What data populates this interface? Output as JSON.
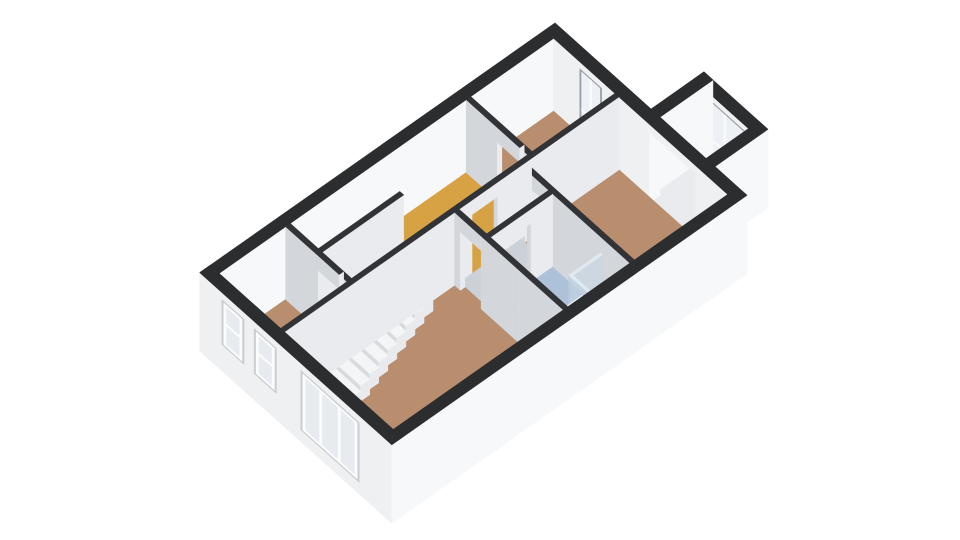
{
  "meta": {
    "view_label": "3D dollhouse floor plan view",
    "background": "#ffffff"
  },
  "floorplan": {
    "projection": {
      "ox": 555,
      "oy": 23,
      "eu": [
        32,
        28.7
      ],
      "ev": [
        -37,
        26
      ],
      "hz": 28,
      "wallH": 2.6
    },
    "palette": {
      "ext": {
        "top": "#2c2d2f",
        "pu": "#f7f8f9",
        "pv": "#eef0f2"
      },
      "int": {
        "top": "#323336",
        "pu": "#e9ebee",
        "pv": "#d3d6da"
      },
      "fix": {
        "top": "#f7f8fa",
        "pu": "#e7eaec",
        "pv": "#d9dce0"
      },
      "fixlight": {
        "top": "#eef0f2",
        "pu": "#e2e5e8",
        "pv": "#d6dade"
      },
      "rail": {
        "top": "#fbfcfd",
        "pu": "#f1f2f4",
        "pv": "#e4e6e9"
      },
      "door": {
        "top": "#f4f5f7",
        "pu": "#eceef0",
        "pv": "#e0e2e5"
      },
      "step": {
        "top": "#f4f5f7",
        "pu": "#e8eaed",
        "pv": "#d8dbde"
      },
      "glass": {
        "top": "rgba(226,236,243,0.85)",
        "pu": "rgba(198,215,229,0.5)",
        "pv": "rgba(188,207,223,0.55)"
      },
      "floors": {
        "brown": "#b98e6f",
        "yellow": "#d7a243",
        "bath": "#adc2d8",
        "gray": "#ccd1d7",
        "bay": "#e9ebee",
        "hole": "#83878c"
      },
      "window": {
        "frame": "#9aa0a6",
        "glass": "#edf1f5",
        "mullion": "#f8fafb"
      },
      "outwin": {
        "recess": "#c9ccd0",
        "frame": "#fbfcfd",
        "glass": "#e7ebef"
      }
    },
    "items": [
      {
        "t": "box",
        "id": "bay-front-wall",
        "rect": [
          3.0,
          -1.43,
          5.0,
          -1.15
        ],
        "z": [
          -0.2,
          2.6
        ],
        "c": "ext"
      },
      {
        "t": "window",
        "id": "bay-window",
        "vc": -1.15,
        "u": [
          3.18,
          4.82
        ],
        "z": [
          0.18,
          2.38
        ],
        "mv": [
          3.98
        ],
        "mh": [
          [
            1.02,
            3.18,
            3.98
          ],
          [
            1.3,
            3.98,
            4.82
          ]
        ]
      },
      {
        "t": "box",
        "id": "bay-left-wall",
        "rect": [
          3.0,
          -1.43,
          3.28,
          0.0
        ],
        "z": [
          -0.2,
          2.6
        ],
        "c": "ext"
      },
      {
        "t": "floor",
        "id": "bay-floor",
        "rect": [
          3.28,
          -1.15,
          4.72,
          0.28
        ],
        "c": "bay"
      },
      {
        "t": "box",
        "id": "bay-window-sill",
        "rect": [
          3.28,
          -1.15,
          4.72,
          -1.03
        ],
        "z": [
          0,
          0.15
        ],
        "c": "rail"
      },
      {
        "t": "box",
        "id": "bay-right-wall",
        "rect": [
          4.72,
          -1.43,
          5.0,
          0.0
        ],
        "z": [
          -0.2,
          2.6
        ],
        "c": "ext"
      },
      {
        "t": "box",
        "id": "facade-nw",
        "rect": [
          0,
          0,
          0.28,
          9.6
        ],
        "z": [
          -0.2,
          2.6
        ],
        "c": "ext"
      },
      {
        "t": "box",
        "id": "wall-ne-west",
        "rect": [
          0.28,
          0,
          3.28,
          0.28
        ],
        "z": [
          -0.2,
          2.6
        ],
        "c": "ext"
      },
      {
        "t": "window",
        "id": "bedroom-2-window",
        "vc": 0.28,
        "u": [
          1.1,
          1.78
        ],
        "z": [
          0.15,
          2.35
        ],
        "mv": [
          1.44
        ],
        "mh": [
          [
            0.95,
            1.1,
            1.78
          ]
        ]
      },
      {
        "t": "box",
        "id": "bay-opening-lintel",
        "rect": [
          3.28,
          0,
          4.72,
          0.28
        ],
        "z": [
          2.32,
          2.6
        ],
        "c": "ext"
      },
      {
        "t": "box",
        "id": "wall-ne-east",
        "rect": [
          4.72,
          0,
          5.72,
          0.28
        ],
        "z": [
          -0.2,
          2.6
        ],
        "c": "ext"
      },
      {
        "t": "floor",
        "id": "bedroom-2-floor",
        "rect": [
          0.28,
          0.28,
          2.2,
          2.52
        ],
        "c": "brown"
      },
      {
        "t": "floor",
        "id": "bedroom-1-floor",
        "rect": [
          2.32,
          0.28,
          5.72,
          2.8
        ],
        "c": "brown"
      },
      {
        "t": "floor",
        "id": "hall-floor",
        "rect": [
          0.28,
          2.64,
          2.2,
          5.2
        ],
        "c": "yellow"
      },
      {
        "t": "floor",
        "id": "bedroom-2-door-threshold",
        "rect": [
          1.25,
          2.52,
          1.95,
          2.64
        ],
        "c": "brown"
      },
      {
        "t": "floor",
        "id": "chamber-floor",
        "rect": [
          2.32,
          2.92,
          3.18,
          4.6
        ],
        "c": "gray"
      },
      {
        "t": "floor",
        "id": "chamber-door-threshold",
        "rect": [
          2.2,
          3.55,
          2.32,
          4.25
        ],
        "c": "yellow"
      },
      {
        "t": "floor",
        "id": "bedroom-1-door-threshold",
        "rect": [
          2.45,
          2.8,
          3.1,
          2.92
        ],
        "c": "brown"
      },
      {
        "t": "floor",
        "id": "bathroom-floor",
        "rect": [
          3.3,
          2.92,
          5.72,
          4.6
        ],
        "c": "bath"
      },
      {
        "t": "floor",
        "id": "bathroom-door-threshold",
        "rect": [
          3.18,
          3.5,
          3.3,
          4.2
        ],
        "c": "bath"
      },
      {
        "t": "floor",
        "id": "closet-floor",
        "rect": [
          0.28,
          5.2,
          1.16,
          7.4
        ],
        "c": "gray"
      },
      {
        "t": "floor",
        "id": "bedroom-3-floor",
        "rect": [
          0.28,
          7.52,
          2.2,
          9.32
        ],
        "c": "brown"
      },
      {
        "t": "floor",
        "id": "bedroom-3-door-threshold",
        "rect": [
          1.3,
          7.4,
          1.95,
          7.52
        ],
        "c": "brown"
      },
      {
        "t": "floor",
        "id": "living-room-floor",
        "rect": [
          2.32,
          4.72,
          5.72,
          9.32
        ],
        "c": "brown"
      },
      {
        "t": "floor",
        "id": "living-room-door-threshold",
        "rect": [
          2.5,
          4.6,
          3.15,
          4.72
        ],
        "c": "brown"
      },
      {
        "t": "box",
        "id": "wall-bedrooms-divider",
        "rect": [
          2.2,
          0.28,
          2.32,
          2.64
        ],
        "z": [
          0,
          2.6
        ],
        "c": "int"
      },
      {
        "t": "box",
        "id": "wall-bedroom-2-south-a",
        "rect": [
          0.28,
          2.52,
          1.25,
          2.64
        ],
        "z": [
          0,
          2.6
        ],
        "c": "int"
      },
      {
        "t": "box",
        "id": "wall-bedroom-2-south-b",
        "rect": [
          1.95,
          2.52,
          2.32,
          2.64
        ],
        "z": [
          0,
          2.6
        ],
        "c": "int"
      },
      {
        "t": "box",
        "id": "bedroom-2-door-lintel",
        "rect": [
          1.25,
          2.52,
          1.95,
          2.64
        ],
        "z": [
          2.08,
          2.6
        ],
        "c": "int"
      },
      {
        "t": "box",
        "id": "wall-bedroom-1-south-a",
        "rect": [
          2.32,
          2.8,
          2.45,
          2.92
        ],
        "z": [
          0,
          2.6
        ],
        "c": "int"
      },
      {
        "t": "box",
        "id": "bedroom-1-door-lintel",
        "rect": [
          2.45,
          2.8,
          3.1,
          2.92
        ],
        "z": [
          2.08,
          2.6
        ],
        "c": "int"
      },
      {
        "t": "box",
        "id": "wall-bedroom-1-south-b",
        "rect": [
          3.1,
          2.8,
          5.72,
          2.92
        ],
        "z": [
          0,
          2.6
        ],
        "c": "int"
      },
      {
        "t": "box",
        "id": "wall-hall-east-a",
        "rect": [
          2.2,
          2.64,
          2.32,
          3.55
        ],
        "z": [
          0,
          2.6
        ],
        "c": "int"
      },
      {
        "t": "box",
        "id": "chamber-door-lintel",
        "rect": [
          2.2,
          3.55,
          2.32,
          4.25
        ],
        "z": [
          2.08,
          2.6
        ],
        "c": "int"
      },
      {
        "t": "box",
        "id": "wall-hall-east-b",
        "rect": [
          2.2,
          4.25,
          2.32,
          5.2
        ],
        "z": [
          0,
          2.6
        ],
        "c": "int"
      },
      {
        "t": "box",
        "id": "wall-chamber-east-a",
        "rect": [
          3.18,
          2.92,
          3.3,
          3.5
        ],
        "z": [
          0,
          2.6
        ],
        "c": "int"
      },
      {
        "t": "box",
        "id": "bathroom-door-lintel",
        "rect": [
          3.18,
          3.5,
          3.3,
          4.2
        ],
        "z": [
          2.08,
          2.6
        ],
        "c": "int"
      },
      {
        "t": "box",
        "id": "wall-chamber-east-b",
        "rect": [
          3.18,
          4.2,
          3.3,
          4.6
        ],
        "z": [
          0,
          2.6
        ],
        "c": "int"
      },
      {
        "t": "box",
        "id": "wall-stairwell-west",
        "rect": [
          1.16,
          5.2,
          1.28,
          7.4
        ],
        "z": [
          0,
          2.6
        ],
        "c": "int"
      },
      {
        "t": "floor",
        "id": "stairwell-hole",
        "rect": [
          1.28,
          5.2,
          2.2,
          7.4
        ],
        "c": "hole"
      },
      {
        "t": "stairs",
        "id": "staircase",
        "rect": [
          1.28,
          5.2,
          2.2,
          7.4
        ],
        "count": 9,
        "first": -0.05,
        "drop": 0.2
      },
      {
        "t": "box",
        "id": "stair-railing",
        "rect": [
          2.08,
          5.2,
          2.2,
          6.95
        ],
        "z": [
          0,
          0.95
        ],
        "c": "rail"
      },
      {
        "t": "box",
        "id": "wall-bedroom-3-north-a",
        "rect": [
          0.28,
          7.4,
          1.3,
          7.52
        ],
        "z": [
          0,
          2.6
        ],
        "c": "int"
      },
      {
        "t": "box",
        "id": "wall-bedroom-3-north-b",
        "rect": [
          1.95,
          7.4,
          2.32,
          7.52
        ],
        "z": [
          0,
          2.6
        ],
        "c": "int"
      },
      {
        "t": "box",
        "id": "bedroom-3-door-lintel",
        "rect": [
          1.3,
          7.4,
          1.95,
          7.52
        ],
        "z": [
          2.08,
          2.6
        ],
        "c": "int"
      },
      {
        "t": "box",
        "id": "bedroom-3-door-panel",
        "rect": [
          2.0,
          6.75,
          2.07,
          7.4
        ],
        "z": [
          0,
          2.04
        ],
        "c": "door"
      },
      {
        "t": "box",
        "id": "wall-living-west",
        "rect": [
          2.2,
          5.2,
          2.32,
          9.32
        ],
        "z": [
          0,
          2.6
        ],
        "c": "int"
      },
      {
        "t": "box",
        "id": "shower-glass-side",
        "rect": [
          4.8,
          2.92,
          4.86,
          3.78
        ],
        "z": [
          0,
          2.02
        ],
        "c": "glass"
      },
      {
        "t": "box",
        "id": "shower-tray",
        "rect": [
          4.86,
          2.92,
          5.72,
          3.72
        ],
        "z": [
          0,
          0.07
        ],
        "c": "fixlight"
      },
      {
        "t": "box",
        "id": "shower-head",
        "rect": [
          5.6,
          2.98,
          5.68,
          3.06
        ],
        "z": [
          1.1,
          2.15
        ],
        "c": "fix"
      },
      {
        "t": "box",
        "id": "toilet-bowl",
        "rect": [
          3.55,
          4.16,
          3.91,
          4.47
        ],
        "z": [
          0,
          0.43
        ],
        "c": "fix"
      },
      {
        "t": "box",
        "id": "toilet-tank",
        "rect": [
          3.59,
          4.47,
          3.87,
          4.6
        ],
        "z": [
          0,
          0.78
        ],
        "c": "fix"
      },
      {
        "t": "box",
        "id": "shower-glass-front",
        "rect": [
          4.86,
          3.72,
          5.72,
          3.78
        ],
        "z": [
          0,
          2.02
        ],
        "c": "glass"
      },
      {
        "t": "box",
        "id": "bathroom-cabinet",
        "rect": [
          5.42,
          3.95,
          5.72,
          4.6
        ],
        "z": [
          0,
          2.1
        ],
        "c": "fix"
      },
      {
        "t": "box",
        "id": "vanity-unit",
        "rect": [
          4.42,
          4.15,
          5.38,
          4.6
        ],
        "z": [
          0,
          0.84
        ],
        "c": "fix"
      },
      {
        "t": "box",
        "id": "vanity-sink",
        "rect": [
          4.55,
          4.22,
          5.05,
          4.52
        ],
        "z": [
          0.84,
          0.9
        ],
        "c": "rail"
      },
      {
        "t": "box",
        "id": "vanity-faucet",
        "rect": [
          4.77,
          4.5,
          4.83,
          4.56
        ],
        "z": [
          0.9,
          1.1
        ],
        "c": "fixlight"
      },
      {
        "t": "box",
        "id": "wall-bathroom-south-a",
        "rect": [
          2.32,
          4.6,
          2.5,
          4.72
        ],
        "z": [
          0,
          2.6
        ],
        "c": "int"
      },
      {
        "t": "box",
        "id": "living-room-door-lintel",
        "rect": [
          2.5,
          4.6,
          3.15,
          4.72
        ],
        "z": [
          2.08,
          2.6
        ],
        "c": "int"
      },
      {
        "t": "box",
        "id": "wall-bathroom-south-b",
        "rect": [
          3.15,
          4.6,
          4.35,
          4.72
        ],
        "z": [
          0,
          2.6
        ],
        "c": "int"
      },
      {
        "t": "box",
        "id": "wall-bathroom-south-c",
        "rect": [
          4.35,
          4.6,
          5.72,
          4.72
        ],
        "z": [
          0,
          2.6
        ],
        "c": "int"
      },
      {
        "t": "box",
        "id": "facade-se",
        "rect": [
          5.72,
          0,
          6.0,
          9.6
        ],
        "z": [
          -0.2,
          2.6
        ],
        "c": "ext"
      },
      {
        "t": "box",
        "id": "facade-sw",
        "rect": [
          0,
          9.32,
          6.0,
          9.6
        ],
        "z": [
          -0.2,
          2.6
        ],
        "c": "ext"
      },
      {
        "t": "outwin",
        "id": "bedroom-3-window-1",
        "vc": 9.6,
        "u": [
          0.75,
          1.32
        ],
        "z": [
          0.8,
          2.28
        ],
        "mh": [
          1.58
        ]
      },
      {
        "t": "outwin",
        "id": "bedroom-3-window-2",
        "vc": 9.6,
        "u": [
          1.76,
          2.33
        ],
        "z": [
          0.8,
          2.28
        ],
        "mh": [
          1.58
        ]
      },
      {
        "t": "outwin",
        "id": "living-room-window",
        "vc": 9.6,
        "u": [
          3.22,
          4.92
        ],
        "z": [
          0.28,
          2.28
        ],
        "mv": [
          3.78,
          4.36
        ]
      }
    ]
  }
}
